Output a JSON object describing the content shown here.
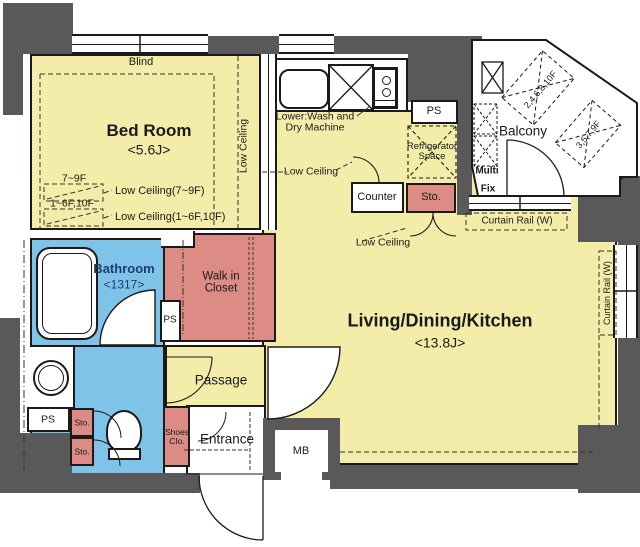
{
  "colors": {
    "wall": "#595959",
    "room_yellow": "#F3EDA9",
    "closet_pink": "#DC8C84",
    "bath_blue": "#7FC3E8",
    "bath_text_navy": "#1d3d72",
    "line": "#1a1a1a"
  },
  "rooms": {
    "bedroom": {
      "name": "Bed Room",
      "size": "<5.6J>"
    },
    "ldk": {
      "name": "Living/Dining/Kitchen",
      "size": "<13.8J>"
    },
    "bathroom": {
      "name": "Bathroom",
      "size": "<1317>"
    },
    "walk_in_closet": {
      "line1": "Walk in",
      "line2": "Closet"
    },
    "passage": {
      "name": "Passage"
    },
    "entrance": {
      "name": "Entrance"
    },
    "balcony": {
      "name": "Balcony"
    }
  },
  "labels": {
    "blind": "Blind",
    "low_ceiling": "Low Ceiling",
    "lc1_floors": "7~9F",
    "lc1_text": "Low Ceiling(7~9F)",
    "lc2_floors": "1~6F,10F",
    "lc2_text": "Low Ceiling(1~6F,10F)",
    "lower_wash_line1": "Lower:Wash and",
    "lower_wash_line2": "Dry Machine",
    "ps": "PS",
    "refrigerator_line1": "Refrigerator",
    "refrigerator_line2": "Space",
    "balcony_floors_a": "2,4,6,8,10F",
    "balcony_floors_b": "3,5,7,9F",
    "multi": "Multi",
    "fix": "Fix",
    "curtain_rail": "Curtain Rail (W)",
    "counter": "Counter",
    "sto": "Sto.",
    "shoes_line1": "Shoes",
    "shoes_line2": "Clo.",
    "mb": "MB"
  }
}
